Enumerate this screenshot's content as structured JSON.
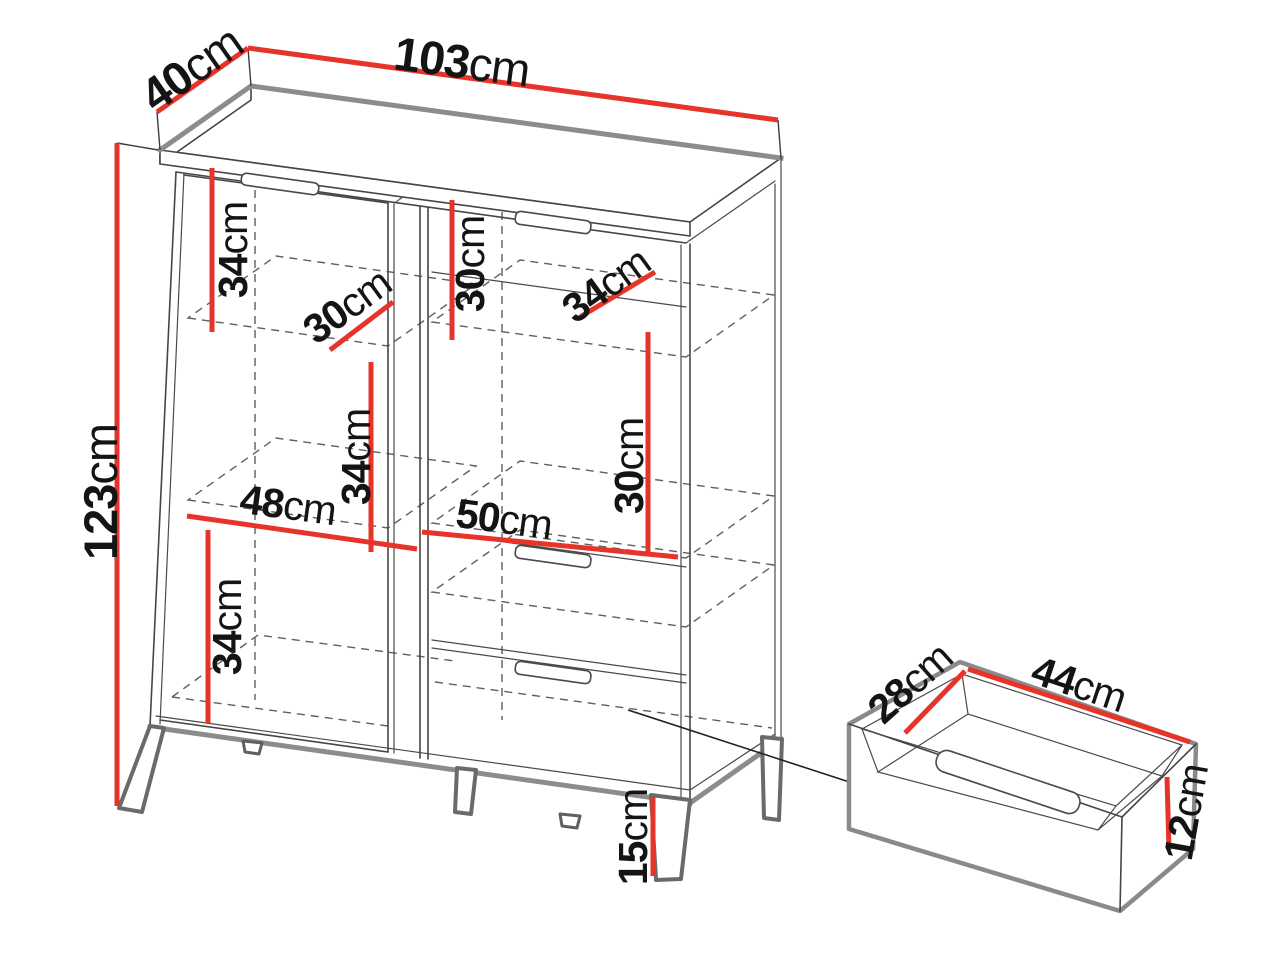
{
  "diagram": {
    "subject": "cabinet-dimension-diagram",
    "units": "cm",
    "cabinet_overall": {
      "width_cm": 103,
      "depth_cm": 40,
      "height_cm": 123
    },
    "drawer_overall": {
      "width_cm": 44,
      "depth_cm": 28,
      "height_cm": 12
    }
  },
  "labels": {
    "top_width": {
      "value": "103",
      "unit": "cm"
    },
    "top_depth": {
      "value": "40",
      "unit": "cm"
    },
    "height": {
      "value": "123",
      "unit": "cm"
    },
    "left_top": {
      "value": "34",
      "unit": "cm"
    },
    "left_shelf_depth": {
      "value": "30",
      "unit": "cm"
    },
    "left_mid": {
      "value": "34",
      "unit": "cm"
    },
    "left_bottom": {
      "value": "34",
      "unit": "cm"
    },
    "left_width": {
      "value": "48",
      "unit": "cm"
    },
    "right_top": {
      "value": "30",
      "unit": "cm"
    },
    "right_shelf_depth": {
      "value": "34",
      "unit": "cm"
    },
    "right_mid": {
      "value": "30",
      "unit": "cm"
    },
    "right_width": {
      "value": "50",
      "unit": "cm"
    },
    "leg": {
      "value": "15",
      "unit": "cm"
    },
    "drawer_depth": {
      "value": "28",
      "unit": "cm"
    },
    "drawer_width": {
      "value": "44",
      "unit": "cm"
    },
    "drawer_height": {
      "value": "12",
      "unit": "cm"
    }
  },
  "colors": {
    "dimension_red": "#e6342a",
    "line_dark": "#454545",
    "edge_gray": "#8c8c8c",
    "text": "#141414",
    "background": "#ffffff"
  }
}
